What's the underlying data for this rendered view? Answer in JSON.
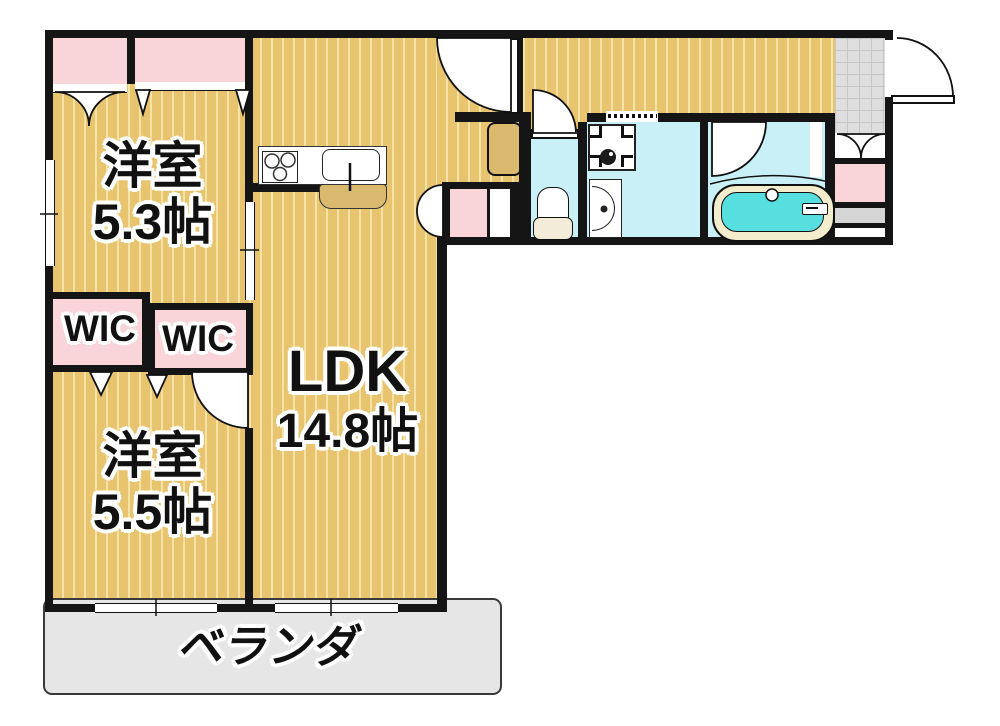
{
  "plan": {
    "type": "apartment-floor-plan",
    "rooms": {
      "bedroom1": {
        "name": "洋室",
        "size": "5.3帖"
      },
      "bedroom2": {
        "name": "洋室",
        "size": "5.5帖"
      },
      "ldk": {
        "name": "LDK",
        "size": "14.8帖"
      },
      "wic_left": {
        "label": "WIC"
      },
      "wic_right": {
        "label": "WIC"
      },
      "veranda": {
        "label": "ベランダ"
      }
    },
    "colors": {
      "floor_tan": "#e9c46f",
      "floor_stripe": "#f5e2a6",
      "closet_pink": "#f9d4d9",
      "wet_area_cyan": "#c9f0f6",
      "tub_water": "#57dfe0",
      "tub_rim": "#f3edcd",
      "veranda_grey": "#e6e6e6",
      "entrance_tile_grey": "#dedede",
      "wall_black": "#151515"
    }
  }
}
